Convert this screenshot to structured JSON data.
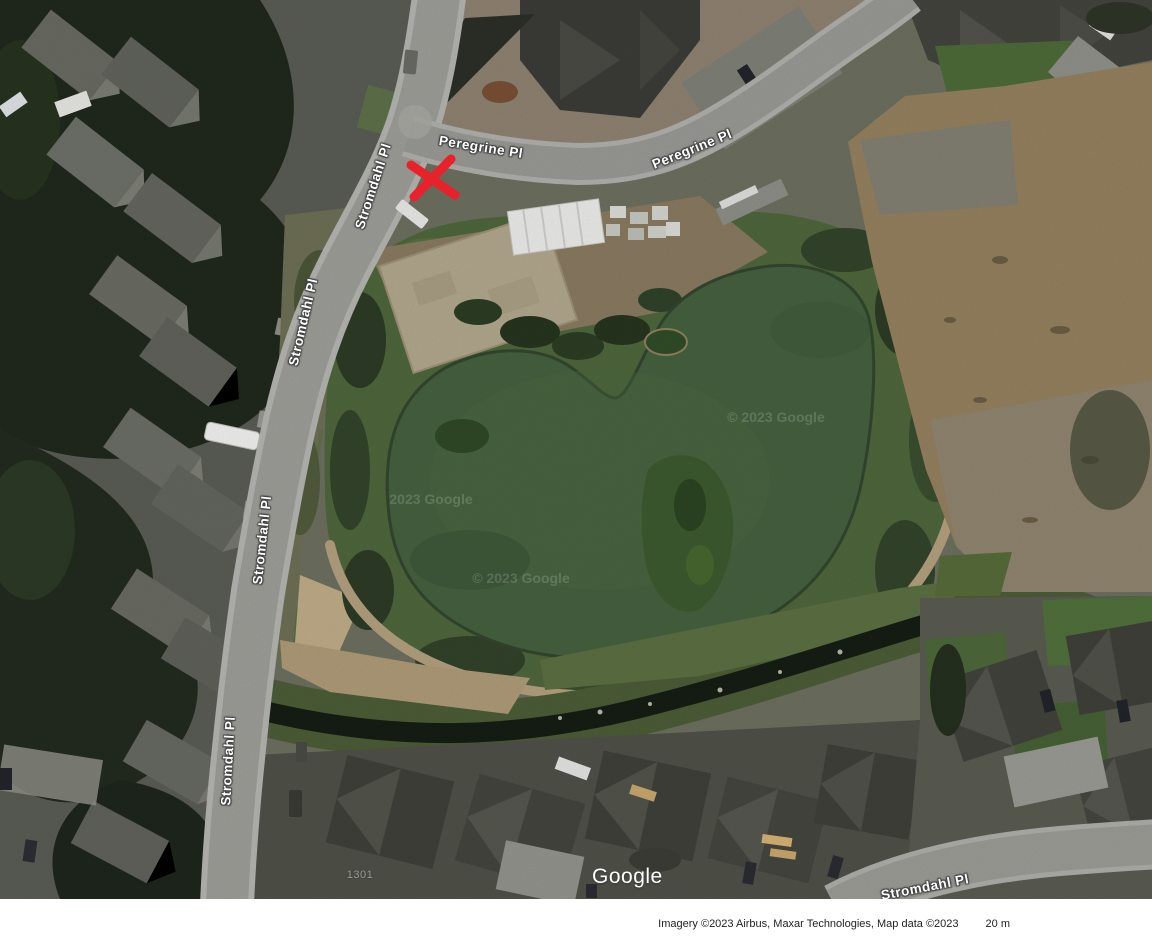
{
  "map": {
    "type": "satellite-imagery",
    "street_labels": [
      {
        "text": "Peregrine Pl"
      },
      {
        "text": "Peregrine Pl"
      },
      {
        "text": "Stromdahl Pl"
      },
      {
        "text": "Stromdahl Pl"
      },
      {
        "text": "Stromdahl Pl"
      },
      {
        "text": "Stromdahl Pl"
      },
      {
        "text": "Stromdahl Pl"
      }
    ],
    "parcel_number": "1301",
    "watermarks": [
      {
        "text": "2023 Google"
      },
      {
        "text": "© 2023 Google"
      },
      {
        "text": "© 2023 Google"
      }
    ],
    "logo_text": "Google",
    "marker": {
      "shape": "red-x",
      "color": "#e8212b",
      "x": 433,
      "y": 177
    },
    "features": {
      "pond_color": "#45613f",
      "dirt_field_color": "#94815f",
      "road_color": "#9e9e99",
      "roof_color": "#4a4b45"
    }
  },
  "footer": {
    "attribution": "Imagery ©2023 Airbus, Maxar Technologies, Map data ©2023",
    "scale_text": "20 m"
  }
}
